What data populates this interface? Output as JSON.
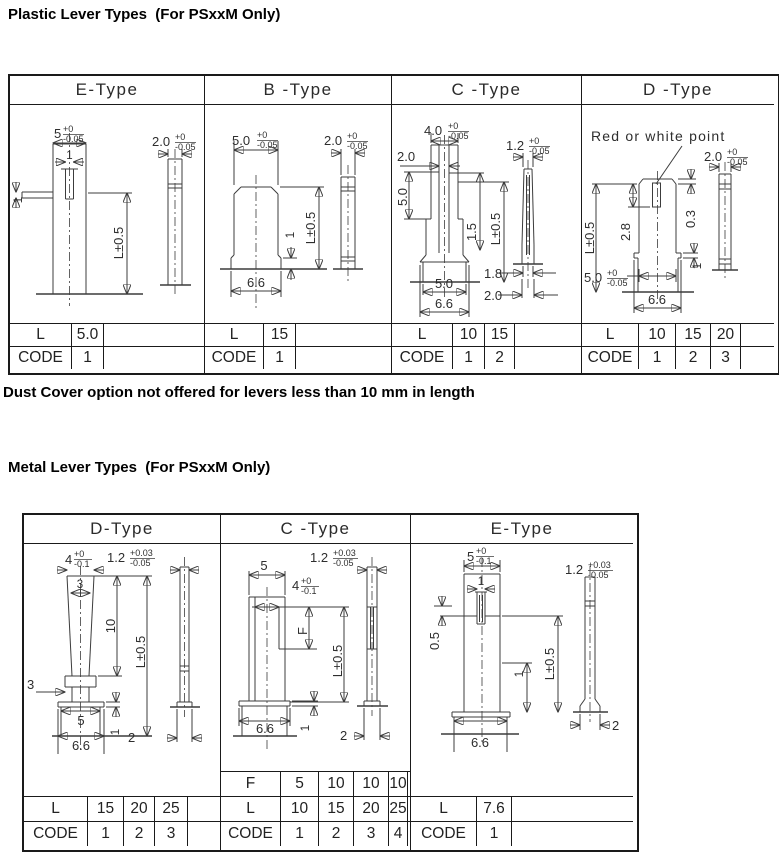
{
  "page": {
    "title_plastic": "Plastic Lever Types  (For PSxxM Only)",
    "note": "Dust Cover option not offered for levers less than 10 mm in length",
    "title_metal": "Metal Lever Types  (For PSxxM Only)"
  },
  "labels": {
    "L": "L",
    "CODE": "CODE",
    "F": "F"
  },
  "plastic": {
    "headers": [
      "E-Type",
      "B -Type",
      "C -Type",
      "D -Type"
    ],
    "e": {
      "w": {
        "v": "5",
        "p": "+0",
        "m": "-0.05"
      },
      "t": {
        "v": "2.0",
        "p": "+0",
        "m": "-0.05"
      },
      "slot": "1",
      "tab": "1",
      "len": "L±0.5",
      "rows": {
        "L": [
          "5.0"
        ],
        "CODE": [
          "1"
        ]
      }
    },
    "b": {
      "w": {
        "v": "5.0",
        "p": "+0",
        "m": "-0.05"
      },
      "t": {
        "v": "2.0",
        "p": "+0",
        "m": "-0.05"
      },
      "len": "L±0.5",
      "step": "1",
      "base": "6.6",
      "rows": {
        "L": [
          "15"
        ],
        "CODE": [
          "1"
        ]
      }
    },
    "c": {
      "w": {
        "v": "4.0",
        "p": "+0",
        "m": "-0.05"
      },
      "inner": "2.0",
      "upper": "5.0",
      "mid": "1.5",
      "len": "L±0.5",
      "t": {
        "v": "1.2",
        "p": "+0",
        "m": "-0.05"
      },
      "foot1": "1.8",
      "foot2": "2.0",
      "base_top": "5.0",
      "base": "6.6",
      "rows": {
        "L": [
          "10",
          "15"
        ],
        "CODE": [
          "1",
          "2"
        ]
      }
    },
    "d": {
      "note": "Red or white point",
      "t": {
        "v": "2.0",
        "p": "+0",
        "m": "-0.05"
      },
      "len": "L±0.5",
      "depth": "2.8",
      "cham": "0.3",
      "step": "1",
      "w": {
        "v": "5.0",
        "p": "+0",
        "m": "-0.05"
      },
      "base": "6.6",
      "rows": {
        "L": [
          "10",
          "15",
          "20"
        ],
        "CODE": [
          "1",
          "2",
          "3"
        ]
      }
    }
  },
  "metal": {
    "headers": [
      "D-Type",
      "C -Type",
      "E-Type"
    ],
    "d": {
      "w": {
        "v": "4",
        "p": "+0",
        "m": "-0.1"
      },
      "tip": "3",
      "t": {
        "v": "1.2",
        "p": "+0.03",
        "m": "-0.05"
      },
      "ten": "10",
      "len": "L±0.5",
      "collar": "3",
      "base_top": "5",
      "base": "6.6",
      "plate": "1",
      "foot": "2",
      "rows": {
        "L": [
          "15",
          "20",
          "25"
        ],
        "CODE": [
          "1",
          "2",
          "3"
        ]
      }
    },
    "c": {
      "w": "5",
      "t": {
        "v": "1.2",
        "p": "+0.03",
        "m": "-0.05"
      },
      "inner": {
        "v": "4",
        "p": "+0",
        "m": "-0.1"
      },
      "f": "F",
      "len": "L±0.5",
      "base": "6.6",
      "plate": "1",
      "foot": "2",
      "rows": {
        "F": [
          "5",
          "10",
          "10",
          "10"
        ],
        "L": [
          "10",
          "15",
          "20",
          "25"
        ],
        "CODE": [
          "1",
          "2",
          "3",
          "4"
        ]
      }
    },
    "e": {
      "w": {
        "v": "5",
        "p": "+0",
        "m": "-0.1"
      },
      "slot": "1",
      "t": {
        "v": "1.2",
        "p": "+0.03",
        "m": "-0.05"
      },
      "step": "0.5",
      "one": "1",
      "len": "L±0.5",
      "base": "6.6",
      "foot": "2",
      "rows": {
        "L": [
          "7.6"
        ],
        "CODE": [
          "1"
        ]
      }
    }
  }
}
